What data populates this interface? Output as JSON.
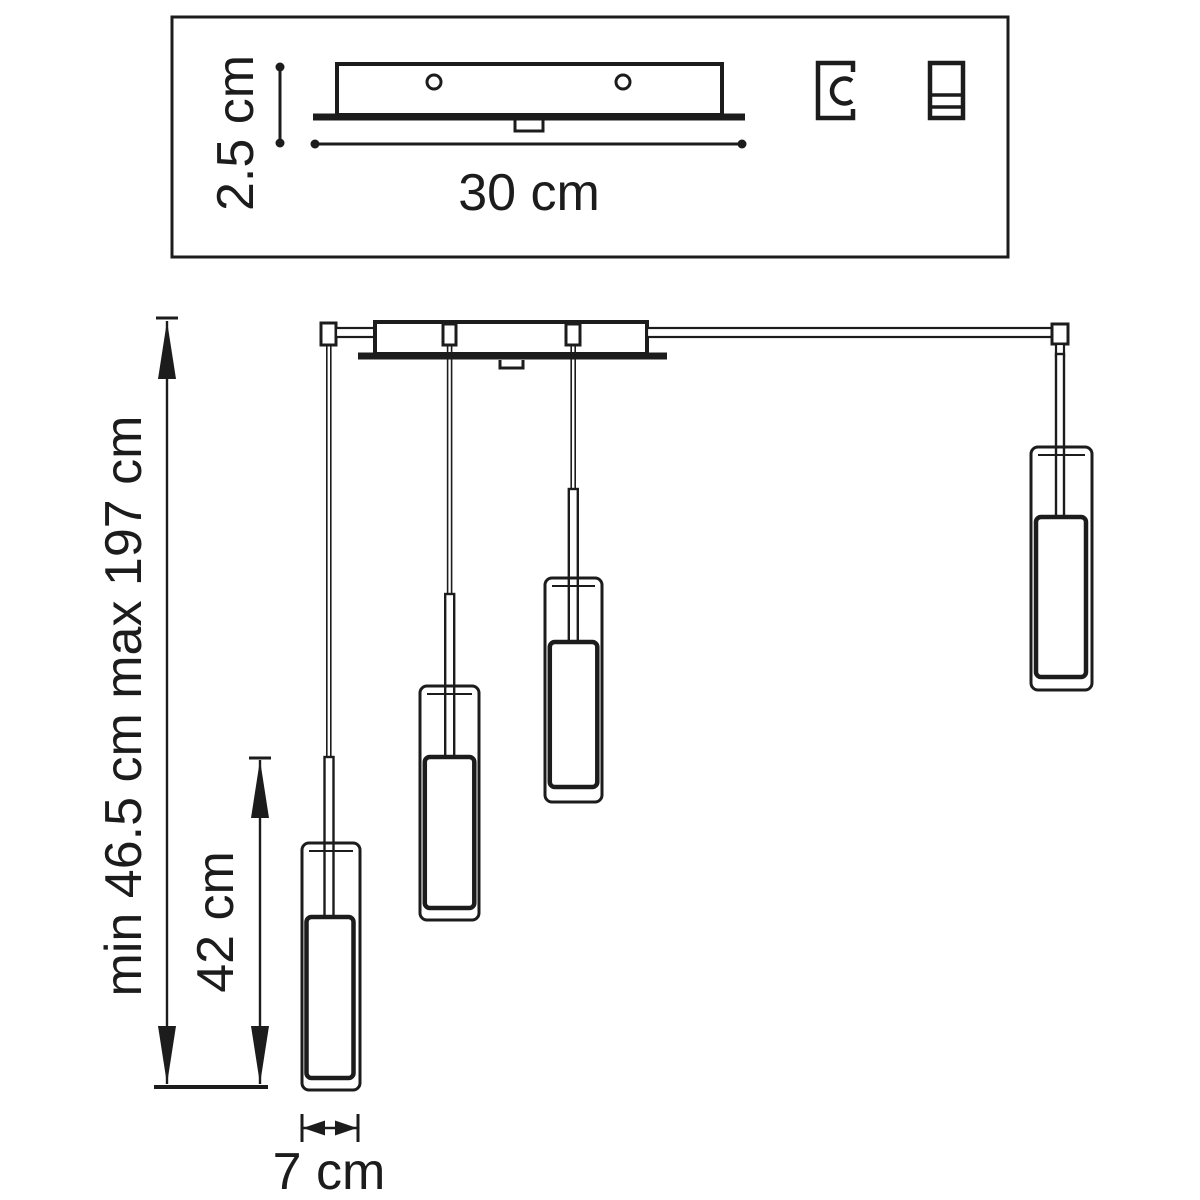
{
  "colors": {
    "background": "#ffffff",
    "line": "#1c1c1c"
  },
  "top_panel": {
    "plate": {
      "height_dimension": "2.5 cm",
      "width_dimension": "30 cm",
      "mounting_hole_count": 2
    },
    "icons": [
      {
        "name": "cable-clamp-icon"
      },
      {
        "name": "terminal-block-icon"
      }
    ]
  },
  "drawing": {
    "overall_height_dimension": "min 46.5 cm max 197 cm",
    "pendant_height_dimension": "42 cm",
    "shade_width_dimension": "7 cm",
    "pendant_count": 4
  }
}
